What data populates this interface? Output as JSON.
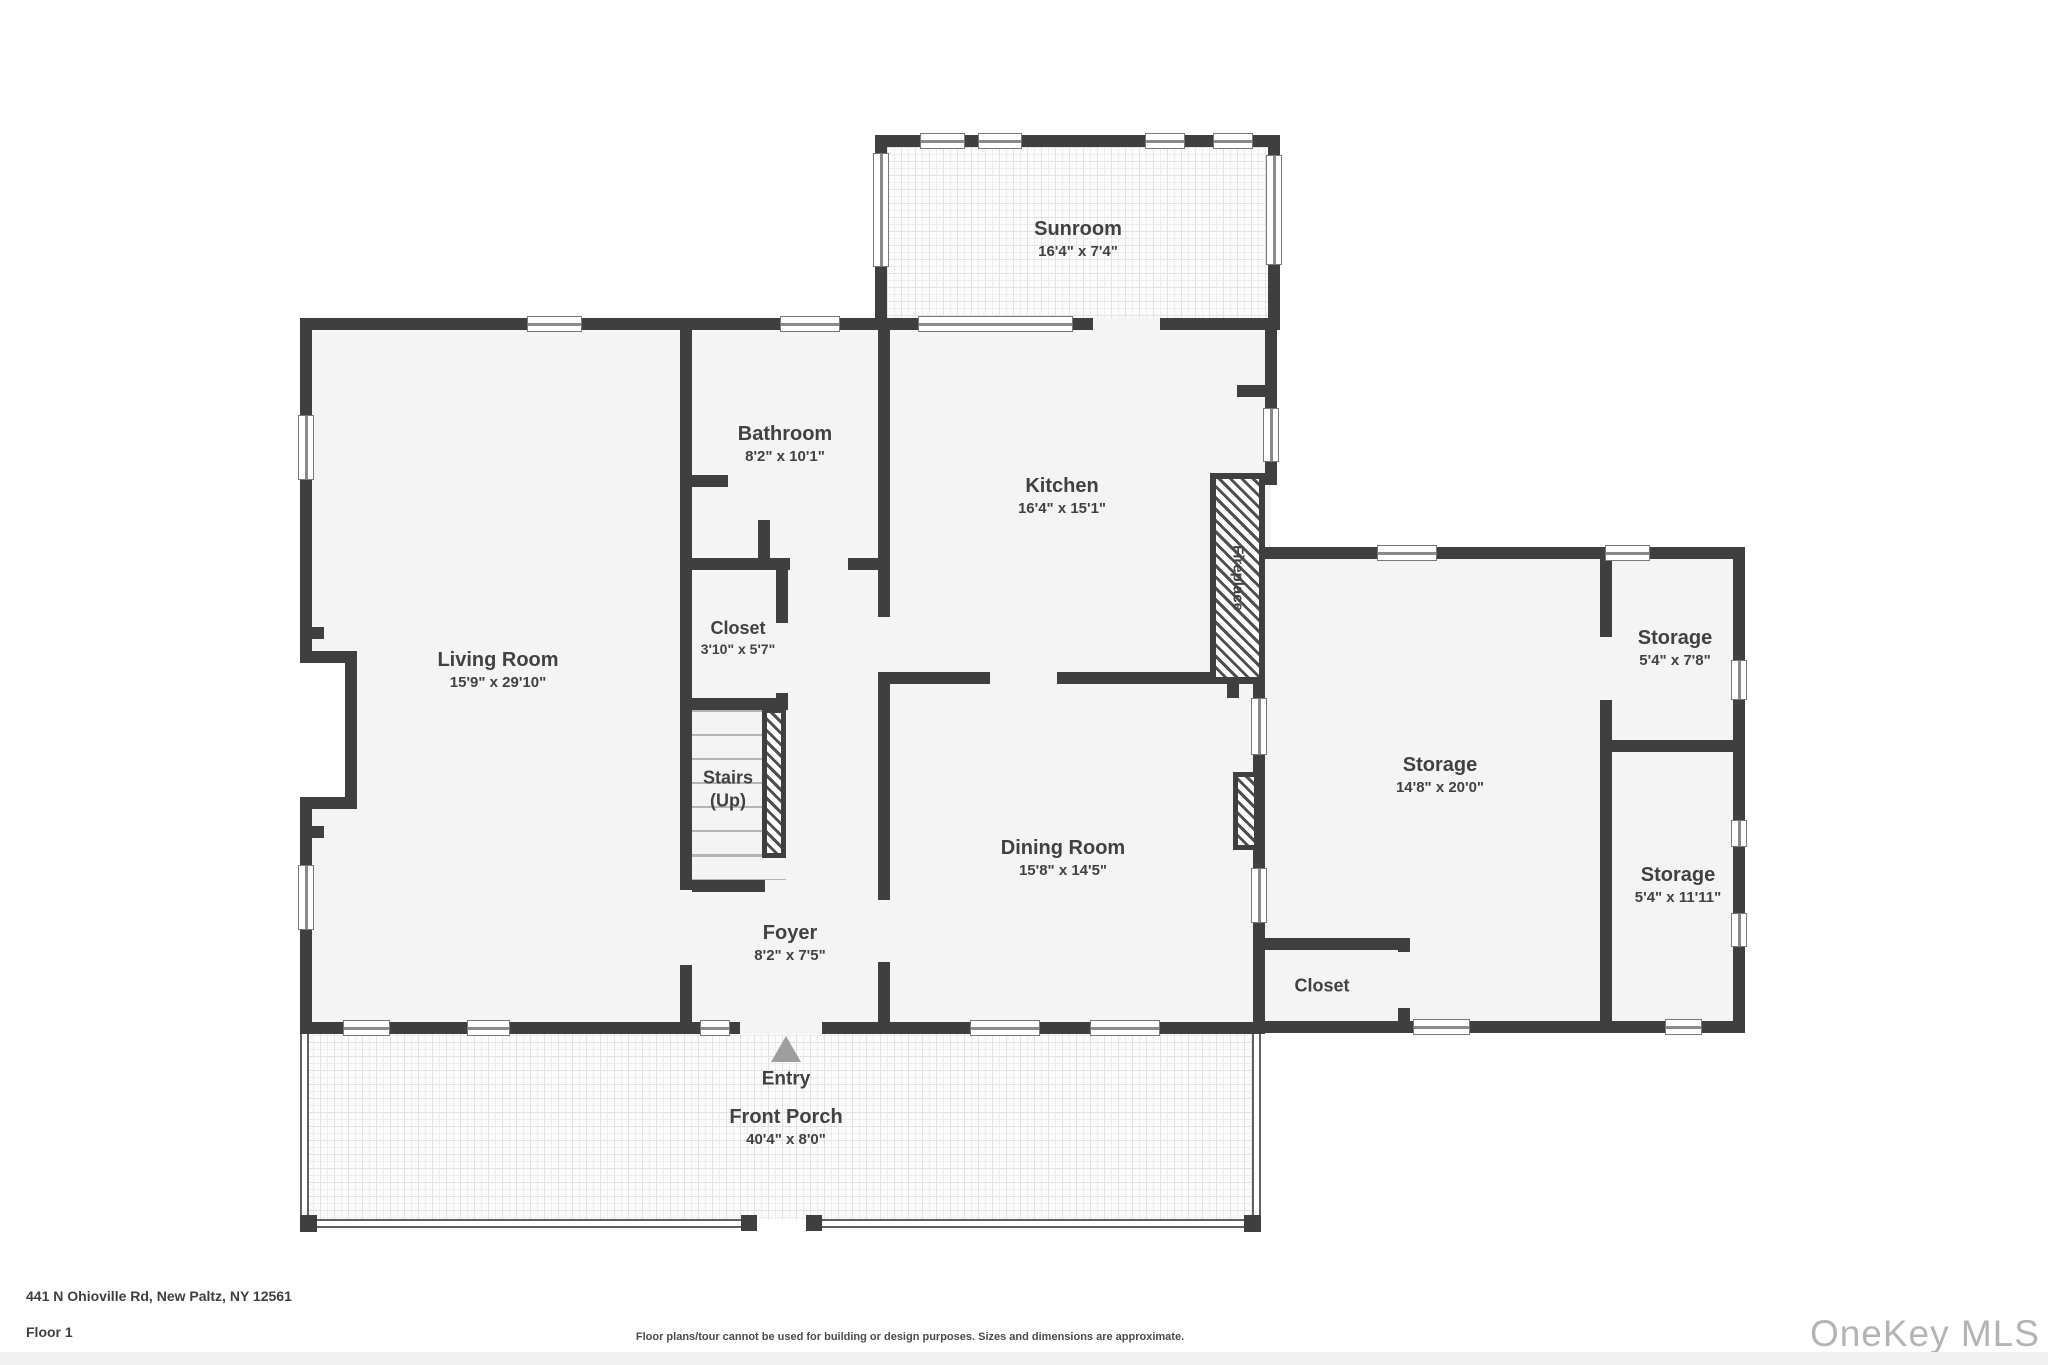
{
  "plan": {
    "rooms": {
      "sunroom": {
        "name": "Sunroom",
        "dims": "16'4\" x 7'4\""
      },
      "bathroom": {
        "name": "Bathroom",
        "dims": "8'2\" x 10'1\""
      },
      "kitchen": {
        "name": "Kitchen",
        "dims": "16'4\" x 15'1\""
      },
      "living_room": {
        "name": "Living Room",
        "dims": "15'9\" x 29'10\""
      },
      "closet": {
        "name": "Closet",
        "dims": "3'10\" x 5'7\""
      },
      "stairs": {
        "name": "Stairs",
        "dims": "(Up)"
      },
      "foyer": {
        "name": "Foyer",
        "dims": "8'2\" x 7'5\""
      },
      "dining_room": {
        "name": "Dining Room",
        "dims": "15'8\" x 14'5\""
      },
      "fireplace": {
        "name": "Fireplace"
      },
      "storage_main": {
        "name": "Storage",
        "dims": "14'8\" x 20'0\""
      },
      "storage_ne": {
        "name": "Storage",
        "dims": "5'4\" x 7'8\""
      },
      "storage_se": {
        "name": "Storage",
        "dims": "5'4\" x 11'11\""
      },
      "storage_closet": {
        "name": "Closet"
      },
      "entry": {
        "name": "Entry"
      },
      "front_porch": {
        "name": "Front Porch",
        "dims": "40'4\" x 8'0\""
      }
    },
    "colors": {
      "wall": "#3f3f3f",
      "floor": "#f4f4f4",
      "label": "#414141",
      "entry_arrow": "#9e9e9e",
      "watermark": "#b4b4b4"
    }
  },
  "footer": {
    "address": "441 N Ohioville Rd, New Paltz, NY 12561",
    "floor_label": "Floor 1",
    "disclaimer": "Floor plans/tour cannot be used for building or design purposes. Sizes and dimensions are approximate.",
    "watermark": "OneKey MLS"
  }
}
